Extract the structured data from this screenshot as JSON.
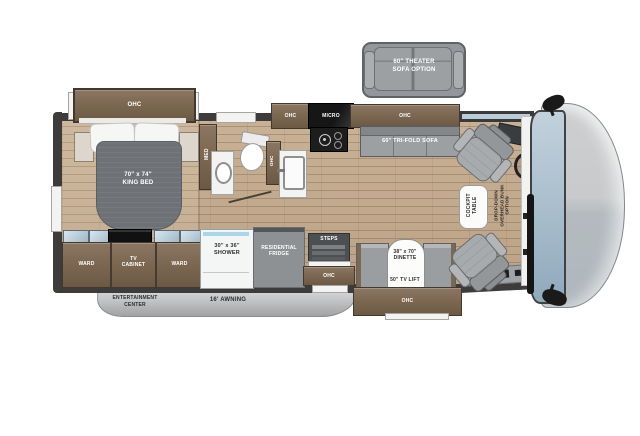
{
  "colors": {
    "floor_wood": "#c3ab8f",
    "cabinet_wood": "#7c6955",
    "wall": "#3e3c3a",
    "upholstery_gray": "#9fa2a4",
    "bed_blanket": "#6e7277",
    "glass_blue": "#b9ccd8",
    "windshield_blue": "#a7bccb",
    "awning_gray": "#c3c5c7",
    "appliance_black": "#1b1b1b",
    "label_light": "#ffffff",
    "label_dark": "#2d2d2d"
  },
  "theater_sofa": {
    "label": "60\" THEATER\nSOFA OPTION"
  },
  "bedroom": {
    "ohc": "OHC",
    "bed": "70\" x 74\"\nKING BED",
    "med": "MED"
  },
  "bathroom": {
    "ohc": "OHC"
  },
  "kitchen": {
    "ohc_left": "OHC",
    "micro": "MICRO",
    "ohc_top": "OHC",
    "trifold_sofa": "60\" TRI-FOLD SOFA"
  },
  "storage_row": {
    "ward_left": "WARD",
    "tv_cabinet": "TV\nCABINET",
    "ward_right": "WARD"
  },
  "shower": {
    "label": "30\" x 36\"\nSHOWER"
  },
  "fridge": {
    "label": "RESIDENTIAL\nFRIDGE"
  },
  "entry": {
    "steps": "STEPS",
    "ohc": "OHC"
  },
  "dinette": {
    "size": "38\" x 70\"\nDINETTE",
    "tv_lift": "50\" TV LIFT",
    "ohc": "OHC"
  },
  "cockpit": {
    "table": "COCKPIT\nTABLE",
    "bunk_option": "DROP-DOWN\nOVERHEAD BUNK\nOPTION"
  },
  "exterior": {
    "entertainment": "OUTSIDE\nENTERTAINMENT\nCENTER",
    "awning": "16' AWNING"
  }
}
